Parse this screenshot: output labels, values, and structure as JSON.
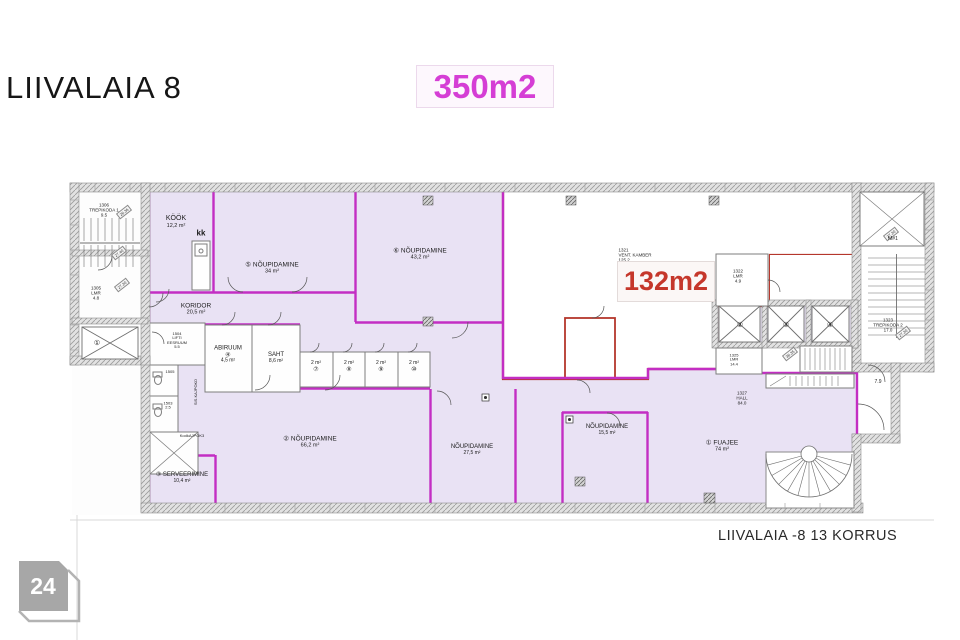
{
  "header": {
    "title": "LIIVALAIA 8",
    "area_badge": "350m2"
  },
  "plan": {
    "highlight_area": "132m2",
    "footer_label": "LIIVALAIA -8  13 KORRUS",
    "page_number": "24",
    "rooms": {
      "trepikoda1": {
        "l1": "1306",
        "l2": "TREPIKODA 1",
        "l3": "9.5"
      },
      "lmr1305": {
        "l1": "1305",
        "l2": "LMR",
        "l3": "4.8"
      },
      "kook": {
        "name": "KÖÖK",
        "area": "12,2 m²",
        "kk": "kk"
      },
      "n5": {
        "name": "⑤ NÕUPIDAMINE",
        "area": "34 m²"
      },
      "n6": {
        "name": "⑥ NÕUPIDAMINE",
        "area": "43,2 m²"
      },
      "koridor": {
        "name": "KORIDOR",
        "area": "20,5 m²"
      },
      "lifti": {
        "l1": "1504",
        "l2": "LIFTI",
        "l3": "EESRUUM",
        "l4": "5.5"
      },
      "r1505": {
        "l1": "1505"
      },
      "r1503": {
        "l1": "1503",
        "l2": "2.5"
      },
      "abiruum": {
        "name": "ABIRUUM",
        "num": "④",
        "area": "4,5 m²"
      },
      "saht": {
        "name": "SAHT",
        "area": "8,6 m²"
      },
      "wc7": {
        "area": "2 m²",
        "num": "⑦"
      },
      "wc8": {
        "area": "2 m²",
        "num": "⑧"
      },
      "wc9": {
        "area": "2 m²",
        "num": "⑨"
      },
      "wc10": {
        "area": "2 m²",
        "num": "⑩"
      },
      "n2": {
        "name": "② NÕUPIDAMINE",
        "area": "66,2 m²"
      },
      "serveerimine": {
        "name": "③ SERVEERIMINE",
        "area": "10,4 m²"
      },
      "n27": {
        "name": "NÕUPIDAMINE",
        "area": "27,5 m²"
      },
      "n15": {
        "name": "NÕUPIDAMINE",
        "area": "15,5 m²"
      },
      "fuajee": {
        "name": "① FUAJEE",
        "area": "74 m²"
      },
      "hall": {
        "l1": "1327",
        "l2": "HALL",
        "l3": "84.0"
      },
      "vent": {
        "l1": "1321",
        "l2": "VENT. KAMBER",
        "l3": "125.2"
      },
      "lmr1322": {
        "l1": "1322",
        "l2": "LMR",
        "l3": "4.9"
      },
      "lmr1325": {
        "l1": "1325",
        "l2": "LMR",
        "l3": "14.4"
      },
      "trepikoda2": {
        "l1": "1323",
        "l2": "TREPIKODA 2",
        "l3": "17.0"
      }
    },
    "lifts": {
      "l1": "①",
      "l2": "②",
      "l3": "③",
      "l4": "④"
    },
    "dims": {
      "c1": "26.36",
      "c2": "27.40",
      "c3": "27.20",
      "c4": "27.20",
      "c5": "27.20",
      "c6": "36.35",
      "d79": "7.9",
      "m1": "M#1"
    },
    "tiny": {
      "t1": "SIS.KAJPOKD",
      "t2": "KodkAJPOK3"
    }
  },
  "colors": {
    "leased_fill": "#e9e2f4",
    "leased_wall": "#c32ec3",
    "vent_wall": "#b5372c",
    "highlight_red": "#c5372b",
    "badge_magenta": "#d53ed5"
  }
}
